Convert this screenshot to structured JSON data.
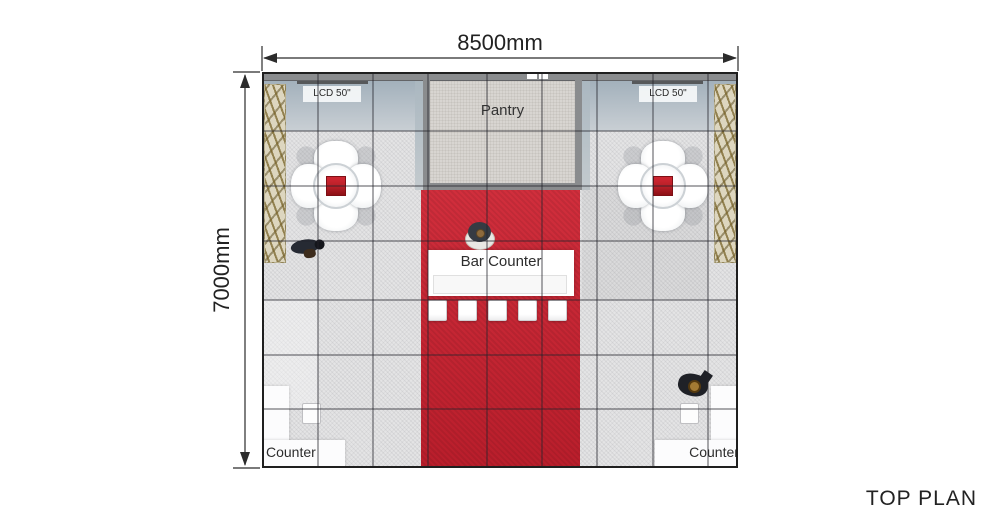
{
  "title": "TOP PLAN",
  "dimensions": {
    "width": "8500mm",
    "height": "7000mm"
  },
  "labels": {
    "pantry": "Pantry",
    "bar_counter": "Bar Counter",
    "lcd_left": "LCD 50\"",
    "lcd_right": "LCD 50\"",
    "counter_left": "Counter",
    "counter_right": "Counter"
  },
  "colors": {
    "carpet_red": "#ce2130",
    "table_red": "#b51f27",
    "wall_gray": "#8a8c8e",
    "floor_gray": "#e4e4e5",
    "pantry_floor": "#d8d5d1",
    "plant_beige": "#ddd6bf",
    "line_dark": "#2b2b2b",
    "text_dark": "#222222"
  }
}
